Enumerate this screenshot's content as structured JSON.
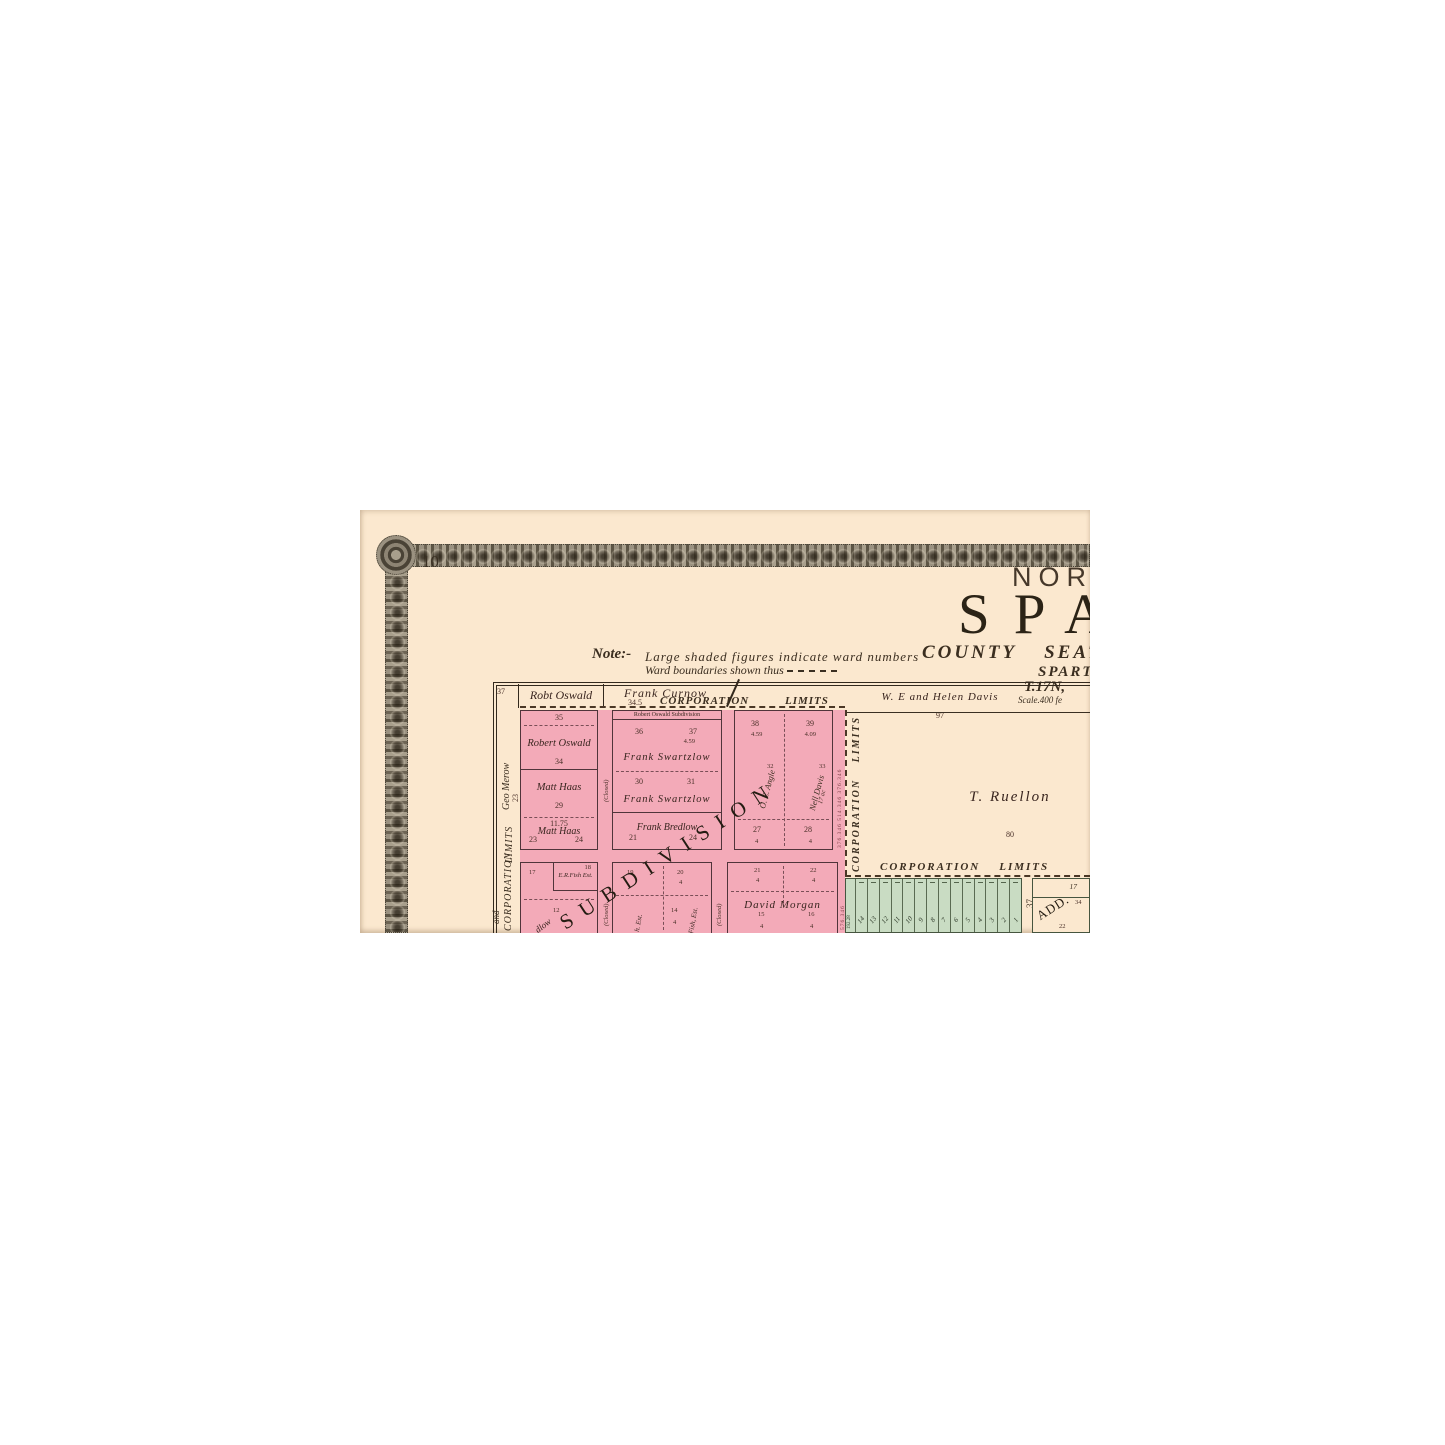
{
  "page_number": "10",
  "title": {
    "direction": "NORTH",
    "city": "SPA",
    "subtitle": "COUNTY  SEAT  O",
    "township": "SPART",
    "range": "T.17N,",
    "scale": "Scale.400 fe"
  },
  "note": {
    "label": "Note:-",
    "line1": "Large shaded figures indicate ward numbers",
    "line2": "Ward boundaries shown thus"
  },
  "margin": {
    "corner_number": "37",
    "geo_merow": "Geo Merow",
    "geo_merow_acres": "23",
    "limits": "LIMITS",
    "corporation": "CORPORATION",
    "and_fragment": "and"
  },
  "top_owners": [
    {
      "name": "Robt Oswald",
      "acres": "32.50"
    },
    {
      "name": "Frank Curnow",
      "acres": "34.5"
    },
    {
      "name": "W. E and Helen Davis",
      "acres": "97"
    }
  ],
  "corporation_limits": {
    "word1": "CORPORATION",
    "word2": "LIMITS"
  },
  "closed_street_label": "(Closed)",
  "subdivision_label": "SUBDIVISION",
  "blocks": {
    "a": {
      "top_num": "35",
      "owner1": "Robert Oswald",
      "num1": "34",
      "owner2": "Matt Haas",
      "num2": "29",
      "acres2": "11.75",
      "owner3": "Matt Haas",
      "num3l": "23",
      "num3r": "24"
    },
    "b": {
      "banner": "Robert Oswald Subdivision",
      "n1l": "36",
      "n1r": "37",
      "a1": "4.59",
      "owner1": "Frank Swartzlow",
      "n2l": "30",
      "n2r": "31",
      "owner2": "Frank Swartzlow",
      "owner3": "Frank Bredlow",
      "n3l": "21",
      "n3r": "24"
    },
    "c": {
      "n1l": "38",
      "a1l": "4.59",
      "n1r": "39",
      "a1r": "4.09",
      "owner_l": "O. E. Angle",
      "n2l": "32",
      "owner_r": "Nell Davis",
      "acres_r": "17 ac",
      "n2r": "33",
      "n3l": "27",
      "a3l": "4",
      "n3r": "28",
      "a3r": "4"
    },
    "d": {
      "n1": "17",
      "owner": "E.R.Fish Est.",
      "n2": "18",
      "n3": "12",
      "fragment": "dlow"
    },
    "e": {
      "n1": "19",
      "n2": "20",
      "a2": "4",
      "vert1": "h. Est.",
      "vert2": "Fish, Est.",
      "n3": "14",
      "a3": "4"
    },
    "f": {
      "n1": "21",
      "a1": "4",
      "n2": "22",
      "a2": "4",
      "owner": "David Morgan",
      "n3l": "15",
      "n3r": "16",
      "a3l": "4",
      "a3r": "4"
    }
  },
  "side_numbers": {
    "row1": "376.346   514.346   376.346",
    "row2": "576.346"
  },
  "ruellon": {
    "name": "T. Ruellon",
    "acres": "80"
  },
  "green_addition": {
    "edge_number": "192.28",
    "lots": [
      "14",
      "13",
      "12",
      "11",
      "10",
      "9",
      "8",
      "7",
      "6",
      "5",
      "4",
      "3",
      "2",
      "1"
    ],
    "right_number": "37",
    "add_block": {
      "top_number": "17",
      "label": "ADD.",
      "small_number": "34",
      "bottom_number": "22"
    }
  }
}
